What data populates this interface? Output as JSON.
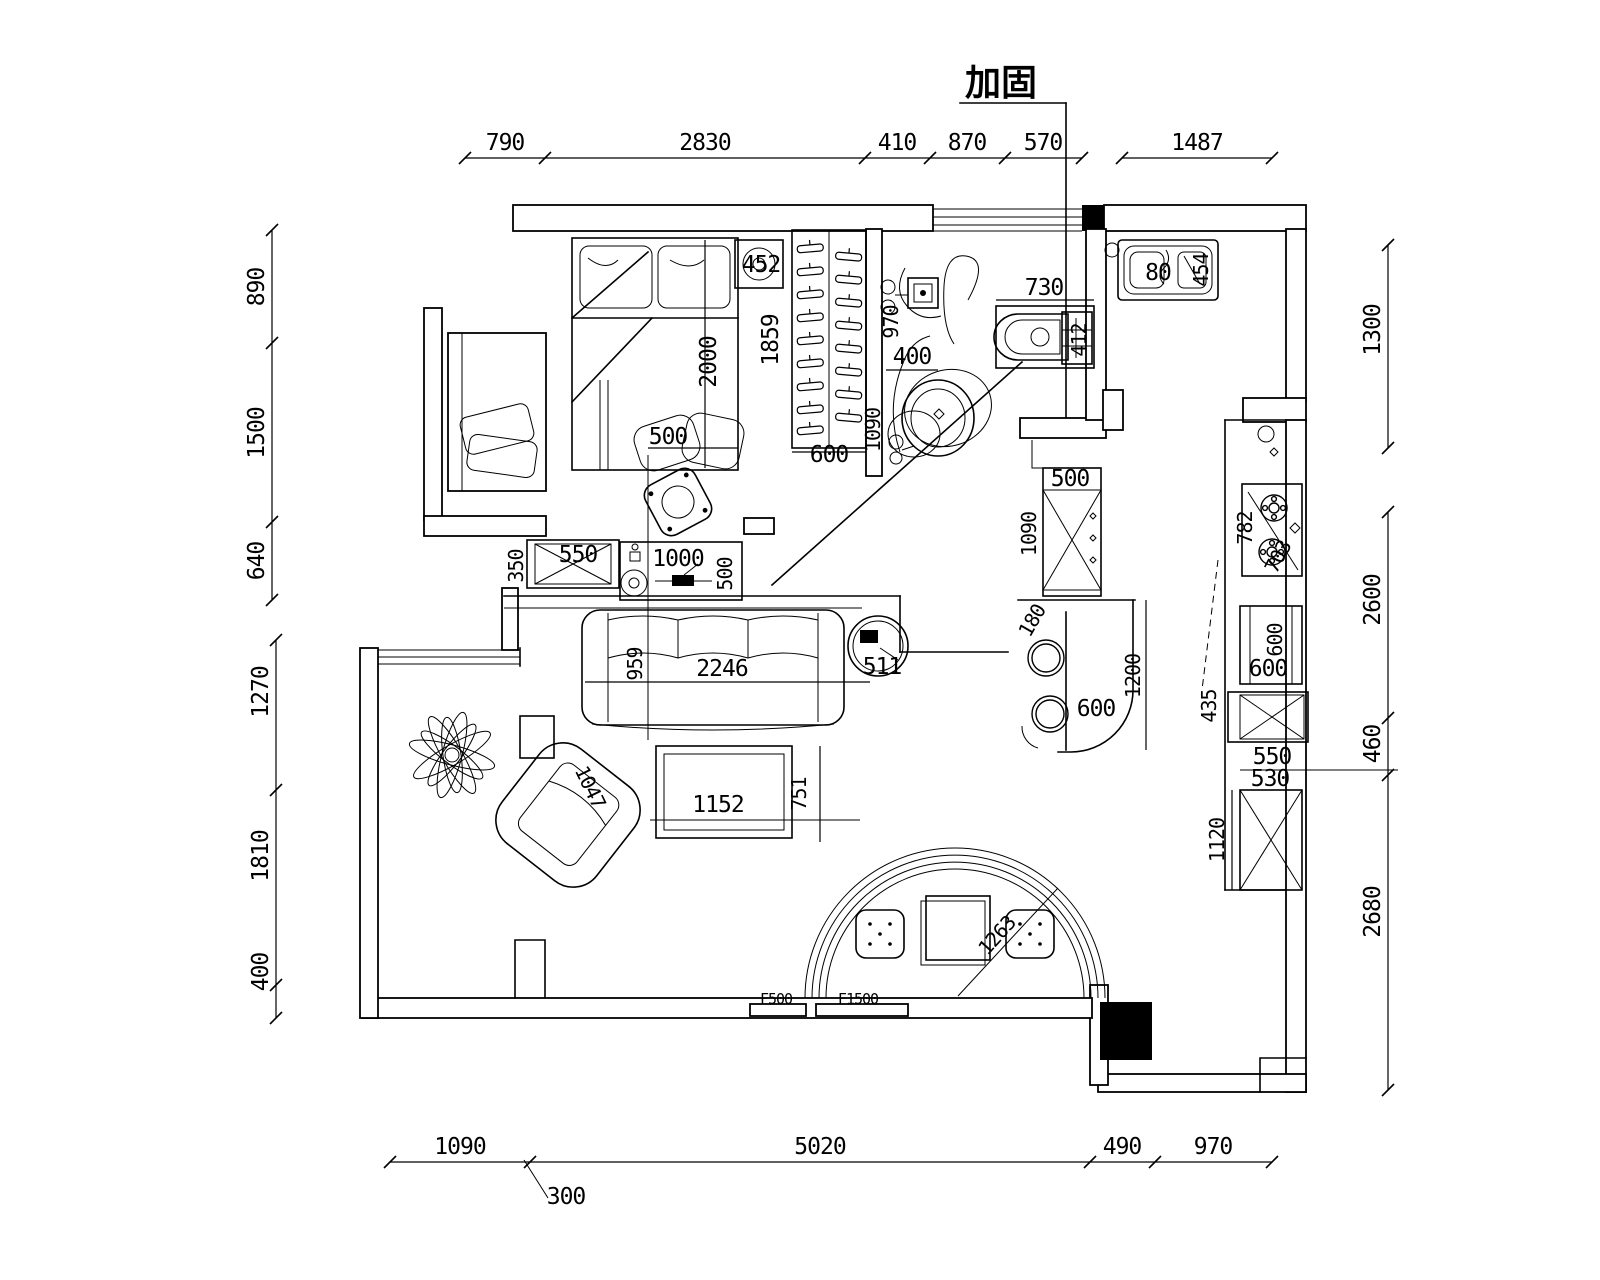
{
  "title": "加固",
  "dims": {
    "top": [
      "790",
      "2830",
      "410",
      "870",
      "570",
      "1487"
    ],
    "left": [
      "890",
      "1500",
      "640",
      "1270",
      "1810",
      "400"
    ],
    "right": [
      "1300",
      "2600",
      "460",
      "2680"
    ],
    "bottom": [
      "1090",
      "5020",
      "490",
      "970"
    ],
    "bottom_offset": "300"
  },
  "bedroom": {
    "bed_length": "2000",
    "bed_width": "500",
    "appliance": "452",
    "closet_length": "1859",
    "closet_depth": "600"
  },
  "bathroom": {
    "drain_run": "970",
    "basin_width": "400",
    "basin_run": "1090",
    "toilet_width": "730",
    "toilet_depth": "412"
  },
  "kitchen": {
    "sink_a": "80",
    "sink_b": "454",
    "fridge_width": "500",
    "fridge_run": "1090",
    "bar_gap": "180",
    "bar_width": "600",
    "bar_run": "1200",
    "stove_a": "782",
    "stove_b": "703",
    "cab_a": "600",
    "cab_b": "600",
    "cab_side": "435",
    "cab_c": "550",
    "cab_d": "530",
    "tall_cab": "1120"
  },
  "living": {
    "cab_side": "350",
    "cab_width": "550",
    "tv_width": "1000",
    "tv_depth": "500",
    "sofa_depth": "959",
    "sofa_width": "2246",
    "side_table": "511",
    "table_width": "1152",
    "table_depth": "751",
    "armchair": "1047"
  },
  "dining": {
    "radius": "1263",
    "window_a": "F500",
    "window_b": "F1500"
  }
}
